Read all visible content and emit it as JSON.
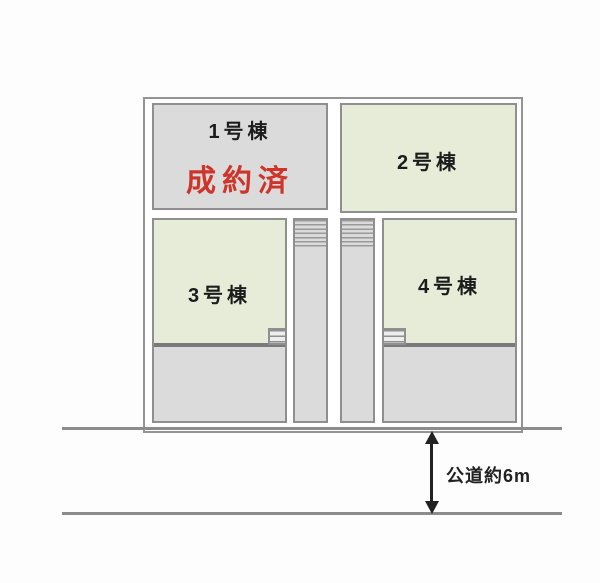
{
  "site_plan": {
    "title": "分譲区画図",
    "lots": [
      {
        "name": "lot-1",
        "label": "1号棟",
        "status_label": "成約済",
        "status": "sold"
      },
      {
        "name": "lot-2",
        "label": "2号棟",
        "status": "available"
      },
      {
        "name": "lot-3",
        "label": "3号棟",
        "status": "available"
      },
      {
        "name": "lot-4",
        "label": "4号棟",
        "status": "available"
      }
    ],
    "road": {
      "label": "公道約6m"
    },
    "colors": {
      "lot_gray": "#dbdbdb",
      "building_green": "#e6ecd7",
      "cell_border": "#8f8f8f",
      "outer_border": "#949494",
      "building_edge_thick": "#7a7a7a",
      "road_line": "#8c8c8c",
      "sold_red": "#cd352b",
      "label_text": "#1c1c1c",
      "arrow_black": "#222222"
    }
  }
}
